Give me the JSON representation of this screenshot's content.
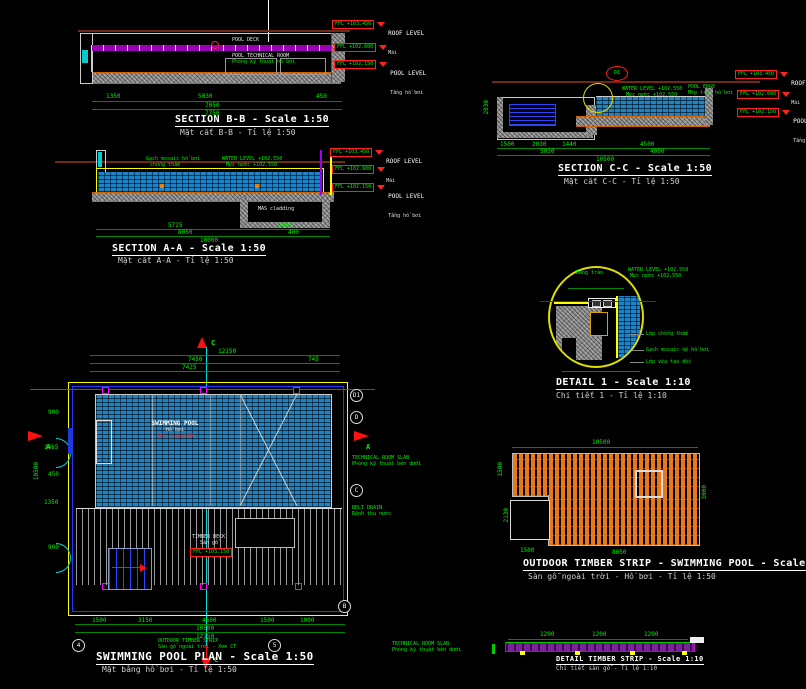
{
  "colors": {
    "background": "#000000",
    "dimension_green": "#00ee00",
    "level_red": "#ff2020",
    "water_blue": "#1b84c8",
    "timber_orange": "#e87818",
    "deck_magenta": "#9a00b4",
    "line_white": "#ffffff",
    "accent_yellow": "#ffff00",
    "accent_cyan": "#00dddd"
  },
  "section_bb": {
    "title": "SECTION B-B  -  Scale 1:50",
    "subtitle": "Mặt cắt B-B  -  Tỉ lệ 1:50",
    "labels": {
      "pool_deck": "POOL DECK",
      "tech_room": "POOL TECHNICAL ROOM",
      "tech_room_vn": "Phòng kỹ thuật hồ bơi"
    },
    "levels": [
      {
        "value": "FFL +103.450",
        "name": "ROOF LEVEL",
        "name_vn": "Mái"
      },
      {
        "value": "FFL +102.600",
        "name": "",
        "name_vn": ""
      },
      {
        "value": "FFL +102.150",
        "name": "POOL LEVEL",
        "name_vn": "Tầng hồ bơi"
      }
    ],
    "dims": [
      "1350",
      "5030",
      "450",
      "7050",
      "7750"
    ]
  },
  "section_aa": {
    "title": "SECTION A-A  -  Scale 1:50",
    "subtitle": "Mặt cắt A-A  -  Tỉ lệ 1:50",
    "labels": {
      "note_left": "Gạch mosaic hồ bơi",
      "note_left2": "chống thấm",
      "water_note": "WATER LEVEL +102.550",
      "water_note_vn": "Mực nước +102.550",
      "cladding": "MAS cladding"
    },
    "levels": [
      {
        "value": "FFL +103.450",
        "name": "ROOF LEVEL",
        "name_vn": "Mái"
      },
      {
        "value": "FFL +102.600",
        "name": "",
        "name_vn": ""
      },
      {
        "value": "FFL +102.150",
        "name": "POOL LEVEL",
        "name_vn": "Tầng hồ bơi"
      }
    ],
    "dims": [
      "5725",
      "2005",
      "8050",
      "400",
      "10000"
    ]
  },
  "section_cc": {
    "title": "SECTION C-C  -  Scale 1:50",
    "subtitle": "Mặt cắt C-C  -  Tỉ lệ 1:50",
    "labels": {
      "detail_bubble": "D1",
      "water_note": "WATER LEVEL +102.550",
      "water_note_vn": "Mực nước +102.550",
      "edge_note": "POOL EDGE",
      "edge_note_vn": "Mép tràn hồ bơi"
    },
    "levels": [
      {
        "value": "FFL +103.450",
        "name": "ROOF LEVEL",
        "name_vn": "Mái"
      },
      {
        "value": "FFL +102.600",
        "name": "",
        "name_vn": ""
      },
      {
        "value": "FFL +102.150",
        "name": "POOL LEVEL",
        "name_vn": "Tầng hồ bơi"
      }
    ],
    "dims": [
      "1500",
      "2030",
      "1440",
      "4500",
      "5030",
      "4000",
      "10500"
    ]
  },
  "detail_1": {
    "title": "DETAIL 1  -  Scale 1:10",
    "subtitle": "Chi tiết 1 -  Tỉ lệ 1:10",
    "notes": {
      "top": "Máng tràn",
      "water": "WATER LEVEL +102.550",
      "water_vn": "Mực nước +102.550",
      "n1": "Lớp chống thấm",
      "n2": "Gạch mosaic ốp hồ bơi",
      "n3": "Lớp vữa tạo dốc"
    }
  },
  "plan": {
    "title": "SWIMMING POOL PLAN  -  Scale 1:50",
    "subtitle": "Mặt bằng hồ bơi  -  Tỉ lệ 1:50",
    "pool": {
      "name": "SWIMMING POOL",
      "name_vn": "Hồ bơi",
      "level": "FFL +102.400"
    },
    "deck": {
      "name": "TIMBER DECK",
      "name_vn": "Sàn gỗ",
      "level": "FFL +103.150"
    },
    "notes": {
      "right1": "TECHNICAL ROOM SLAB",
      "right1_vn": "Phòng kỹ thuật bên dưới",
      "right2": "BELT DRAIN",
      "right2_vn": "Rãnh thu nước",
      "bottom": "OUTDOOR TIMBER STRIP",
      "bottom_vn": "Sàn gỗ ngoài trời - Xem CT",
      "bottom_right": "TECHNICAL ROOM SLAB",
      "bottom_right_vn": "Phòng kỹ thuật bên dưới"
    },
    "grid": {
      "right": [
        "D1",
        "D",
        "C",
        "B"
      ],
      "bottom": [
        "4",
        "5"
      ]
    },
    "section_marks": {
      "top": "C",
      "bottom": "C",
      "left": "A",
      "right": "A"
    },
    "dims_top": [
      "12150",
      "7450",
      "745",
      "7425"
    ],
    "dims_bottom": [
      "1500",
      "3150",
      "4500",
      "1500",
      "1000",
      "10500",
      "12150"
    ],
    "dims_left": [
      "900",
      "1465",
      "450",
      "1350",
      "900",
      "10500"
    ]
  },
  "timber": {
    "title": "OUTDOOR TIMBER STRIP  -  SWIMMING POOL  -  Scale 1:50",
    "subtitle": "Sàn gỗ ngoài trời - Hồ bơi -  Tỉ lệ 1:50",
    "dims": {
      "top": "10500",
      "right": "3000",
      "left_a": "1500",
      "left_b": "2130",
      "bottom_a": "1500",
      "bottom_b": "8050"
    }
  },
  "strip": {
    "title": "DETAIL TIMBER STRIP  -  Scale 1:10",
    "subtitle": "Chi tiết sàn gỗ - Tỉ lệ 1:10",
    "dims": [
      "1200",
      "1200",
      "1200"
    ]
  }
}
